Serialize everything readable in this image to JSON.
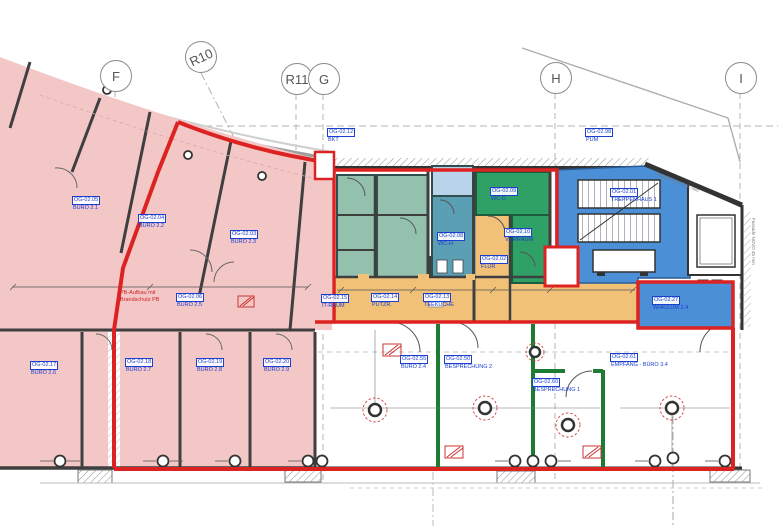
{
  "drawing": {
    "type": "architectural-floor-plan",
    "floor": "OG 02",
    "grid_markers": [
      {
        "label": "F"
      },
      {
        "label": "R10"
      },
      {
        "label": "R11"
      },
      {
        "label": "G"
      },
      {
        "label": "H"
      },
      {
        "label": "I"
      }
    ],
    "rooms": [
      {
        "id": "OG-02.05",
        "name": "BÜRO 2.1"
      },
      {
        "id": "OG-02.04",
        "name": "BÜRO 2.2"
      },
      {
        "id": "OG-02.03",
        "name": "BÜRO 2.3"
      },
      {
        "id": "OG-02.06",
        "name": "BÜRO 2.5"
      },
      {
        "id": "OG-02.17",
        "name": "BÜRO 2.6"
      },
      {
        "id": "OG-02.18",
        "name": "BÜRO 2.7"
      },
      {
        "id": "OG-02.19",
        "name": "BÜRO 2.8"
      },
      {
        "id": "OG-02.20",
        "name": "BÜRO 2.9"
      },
      {
        "id": "OG-02.12",
        "name": "BKT"
      },
      {
        "id": "OG-02.98",
        "name": "PUM"
      },
      {
        "id": "OG-02.08",
        "name": "WC-H"
      },
      {
        "id": "OG-02.09",
        "name": "WC-D"
      },
      {
        "id": "OG-02.10",
        "name": "VORRAUM"
      },
      {
        "id": "OG-02.02",
        "name": "FLUR"
      },
      {
        "id": "OG-02.15",
        "name": "IT-RAUM"
      },
      {
        "id": "OG-02.14",
        "name": "PUTZR."
      },
      {
        "id": "OG-02.13",
        "name": "TEEKÜCHE"
      },
      {
        "id": "OG-02.01",
        "name": "TREPPENHAUS 1"
      },
      {
        "id": "OG-02.27",
        "name": "WHK/LUM 2.4"
      },
      {
        "id": "OG-02.55",
        "name": "BÜRO 2.4"
      },
      {
        "id": "OG-02.50",
        "name": "BESPRECHUNG 2"
      },
      {
        "id": "OG-02.60",
        "name": "BESPRECHUNG 1"
      },
      {
        "id": "OG-02.61",
        "name": "EMPFANG - BÜRO 3.4"
      }
    ],
    "notes": {
      "fire_line1": "PB-Aufbau mit",
      "fire_line2": "Brandschutz PB",
      "facade": "Fassade NOVO 45 mm"
    },
    "colors": {
      "tenant_boundary": "#dd2222",
      "office_fill": "#f4c7c7",
      "corridor_fill": "#f2c178",
      "wet_room_fill": "#5b9fb5",
      "teal_fill": "#93c1ae",
      "green_fill": "#2fa066",
      "stair_fill": "#4b90d6",
      "meeting_wall": "#1e7b33",
      "label_blue": "#1a3fd1"
    }
  }
}
